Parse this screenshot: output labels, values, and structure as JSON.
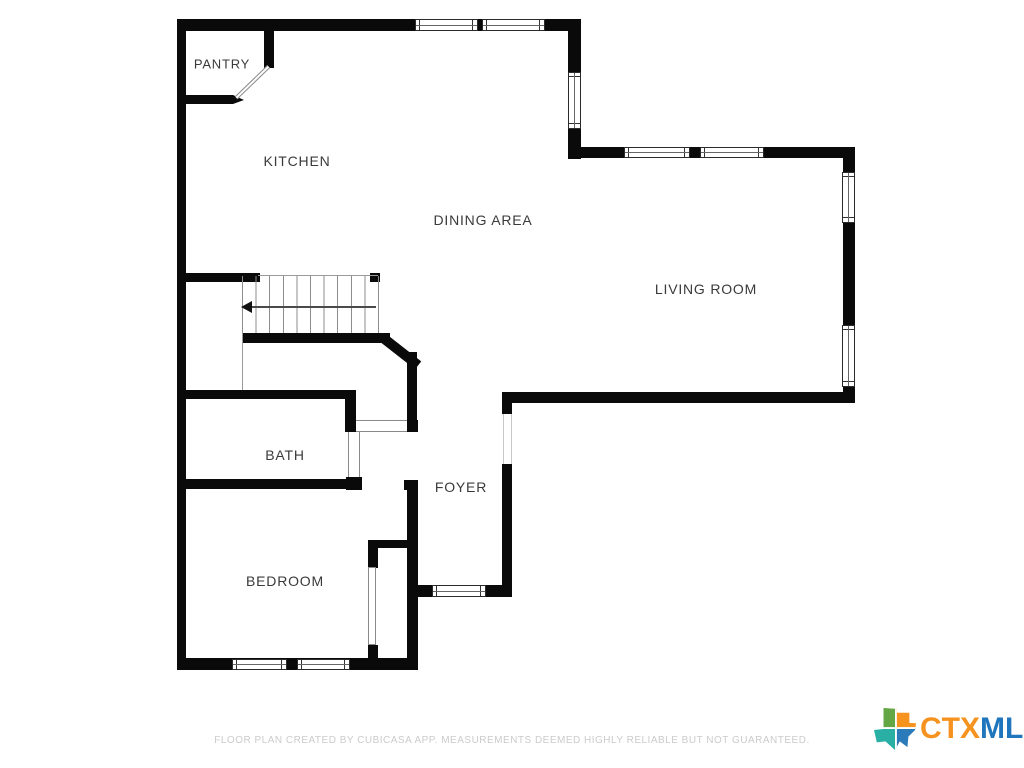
{
  "plan": {
    "rooms": {
      "pantry": "PANTRY",
      "kitchen": "KITCHEN",
      "dining": "DINING AREA",
      "living": "LIVING ROOM",
      "bath": "BATH",
      "foyer": "FOYER",
      "bedroom": "BEDROOM"
    },
    "features": {
      "stairs": "staircase with down direction arrow pointing left",
      "doors": [
        "pantry swing door",
        "bath door",
        "hall doorway",
        "front door opening",
        "bedroom closet door"
      ],
      "windows_count": 10
    }
  },
  "footer": {
    "disclaimer": "FLOOR PLAN CREATED BY CUBICASA APP. MEASUREMENTS DEEMED HIGHLY RELIABLE BUT NOT GUARANTEED."
  },
  "logo": {
    "ctx": "CTX",
    "mls": "MLS",
    "colors": {
      "ctx": "#F6921E",
      "mls": "#1F76BC",
      "texas_green": "#62A744",
      "texas_orange": "#F6921E",
      "texas_teal": "#2AAFA4",
      "texas_blue": "#2B7BBB"
    }
  },
  "colors": {
    "wall": "#0a0a0a",
    "label": "#3a3a3a",
    "background": "#ffffff"
  }
}
